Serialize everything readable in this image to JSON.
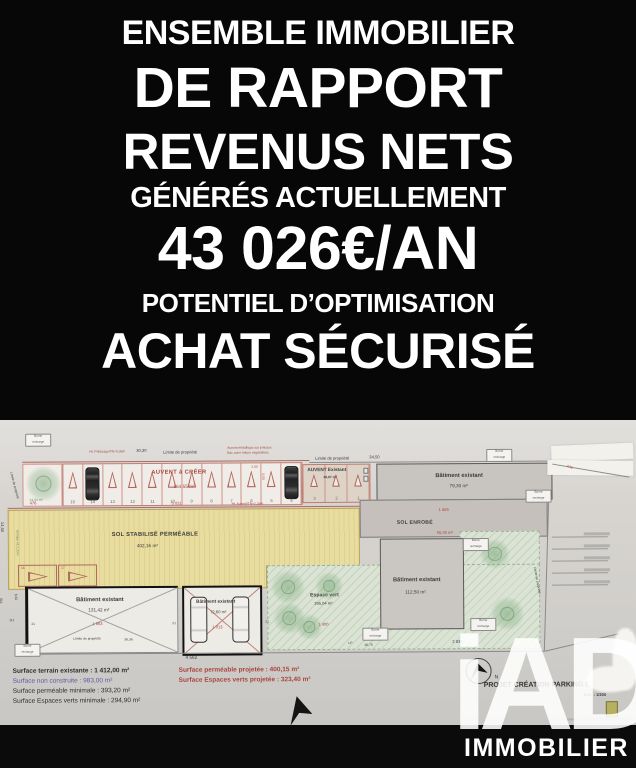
{
  "colors": {
    "hero_bg": "#070707",
    "paper": "#d7d4d0",
    "plan_red": "#a8453c",
    "permeable_yellow": "#e8dc9e",
    "green_space": "#dbe3d4"
  },
  "hero": {
    "line1": "ENSEMBLE IMMOBILIER",
    "line2": "DE RAPPORT",
    "line3": "REVENUS NETS",
    "line4": "GÉNÉRÉS ACTUELLEMENT",
    "line5": "43 026€/AN",
    "line6": "POTENTIEL D’OPTIMISATION",
    "line7": "ACHAT SÉCURISÉ"
  },
  "plan": {
    "top_boundary": {
      "palissade_note": "Ht. Palissage/TN=0,26m",
      "dim_left": "30,30",
      "limite_left": "Limite de propriété",
      "note_1": "Auvent métallique sur poteaux",
      "note_2": "Bac acier toiture végétalisée",
      "limite_right": "Limite de propriété",
      "dim_right": "34,50"
    },
    "carport_new": {
      "title": "AUVENT à CRÉER",
      "area": "164,55 m²",
      "dim_w": "2,50",
      "dim_h": "5,00",
      "stalls": [
        "15",
        "14",
        "13",
        "12",
        "11",
        "10",
        "9",
        "8",
        "7",
        "6",
        "5",
        "4"
      ]
    },
    "carport_existing": {
      "title": "AUVENT Existant",
      "area": "38,97 m²",
      "stalls": [
        "3",
        "2",
        "1"
      ]
    },
    "tree_label": "24,04 m²",
    "building_top": {
      "label": "Bâtiment existant",
      "area": "79,30 m²"
    },
    "sol_stabilise": {
      "label": "SOL STABILISÉ PERMÉABLE",
      "area": "402,16 m²"
    },
    "sol_enrobe": {
      "label": "SOL ENROBÉ",
      "area": "55,50 m²",
      "dim": "1 885"
    },
    "espace_vert": {
      "label": "Espace vert",
      "area": "295,04 m²",
      "dim": "1 400"
    },
    "building_left": {
      "label": "Bâtiment existant",
      "area": "131,42 m²",
      "dim": "1 663",
      "wall_l": "21",
      "wall_r": "21",
      "tick": "111"
    },
    "building_mid": {
      "label": "Bâtiment existant",
      "area": "72,60 m²",
      "dim": "1 013",
      "wall_r": "21"
    },
    "building_right": {
      "label": "Bâtiment existant",
      "area": "112,50 m²"
    },
    "stall_16": "16",
    "stall_17": "17",
    "left_edge": {
      "limite": "Limite de propriété",
      "dim_v": "14,50",
      "grillage": "Grillage Ht.2,00m",
      "sci": "SCI",
      "dim_v2": "8,62"
    },
    "dims": {
      "red_left": "476",
      "red_mid": "5 021",
      "auvent_ht": "Ht. Auvent/TN=2,26m",
      "bottom_main": "4 562",
      "bottom_lp": "LP",
      "bottom_mid": "36,75",
      "bottom_right": "2 832",
      "limite_bottom": "Limite de propriété",
      "limite_bottom_dim": "36,36",
      "right_limite": "Limite de propriété",
      "right_diag": "4,50"
    },
    "tag": {
      "line1": "Borne",
      "line2": "recharge"
    },
    "compass_label": "N",
    "legend": {
      "l1": "Surface terrain existante : 1 412,00 m²",
      "l2": "Surface non construite : 983,00 m²",
      "l3": "Surface perméable minimale : 393,20 m²",
      "l4": "Surface Espaces verts minimale : 294,90 m²",
      "r1": "Surface perméable projetée : 400,15 m²",
      "r2": "Surface Espaces verts projetée : 323,40 m²"
    },
    "title_block": {
      "title": "PROJET CRÉATION PARKING COUVERT",
      "scale": "Ech. : 1/200"
    }
  },
  "footer": {
    "brand": "iAD",
    "label": "IMMOBILIER"
  }
}
